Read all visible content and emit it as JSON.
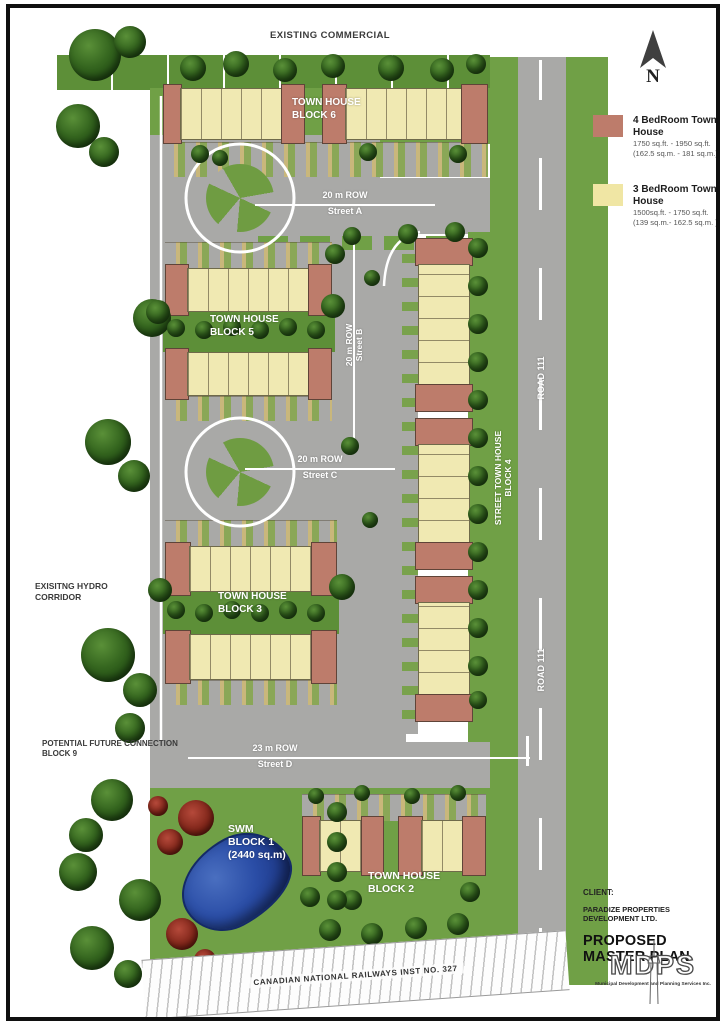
{
  "colors": {
    "road_gray": "#a9a9a7",
    "grass_green": "#70a046",
    "unit_yellow": "#f0e9b2",
    "unit_red": "#bd7c6b",
    "pond_blue": "#2a4da6",
    "legend_red": "#bd7c6b",
    "legend_yellow": "#f0e6a4"
  },
  "compass": {
    "label": "N"
  },
  "legend": {
    "items": [
      {
        "label": "4 BedRoom Town House",
        "area_imperial": "1750 sq.ft. - 1950 sq.ft.",
        "area_metric": "(162.5 sq.m. - 181 sq.m.)",
        "color": "#bd7c6b"
      },
      {
        "label": "3 BedRoom Town House",
        "area_imperial": "1500sq.ft. - 1750 sq.ft.",
        "area_metric": "(139 sq.m.- 162.5 sq.m. )",
        "color": "#f0e6a4"
      }
    ]
  },
  "annotations": {
    "existing_commercial": "EXISTING COMMERCIAL",
    "hydro_line1": "EXISITNG HYDRO",
    "hydro_line2": "CORRIDOR",
    "future_line1": "POTENTIAL FUTURE CONNECTION",
    "future_line2": "BLOCK 9",
    "railway": "CANADIAN NATIONAL RAILWAYS  INST  NO. 327"
  },
  "streets": {
    "a_row": "20 m  ROW",
    "a_name": "Street A",
    "b_row": "20 m ROW",
    "b_name": "Street B",
    "c_row": "20 m  ROW",
    "c_name": "Street C",
    "d_row": "23 m  ROW",
    "d_name": "Street D",
    "road111_upper": "ROAD 111",
    "road111_lower": "ROAD 111",
    "block4_line1": "STREET TOWN HOUSE",
    "block4_line2": "BLOCK 4"
  },
  "blocks": {
    "b6_line1": "TOWN HOUSE",
    "b6_line2": "BLOCK 6",
    "b5_line1": "TOWN HOUSE",
    "b5_line2": "BLOCK 5",
    "b3_line1": "TOWN HOUSE",
    "b3_line2": "BLOCK 3",
    "b2_line1": "TOWN HOUSE",
    "b2_line2": "BLOCK 2",
    "swm_line1": "SWM",
    "swm_line2": "BLOCK 1",
    "swm_line3": "(2440 sq.m)"
  },
  "title_block": {
    "client_label": "CLIENT:",
    "client_name": "PARADIZE PROPERTIES DEVELOPMENT LTD.",
    "title": "PROPOSED MASTER PLAN",
    "logo_acronym": "MDPS",
    "logo_subtitle": "Municipal Development and Planning Services Inc."
  }
}
